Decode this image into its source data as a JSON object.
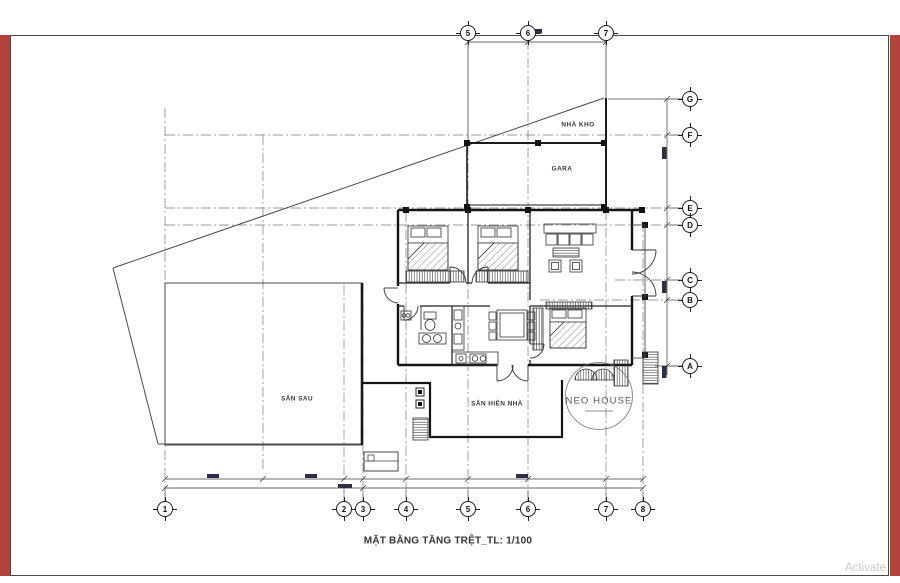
{
  "page": {
    "title": "MẶT BẰNG TẦNG TRỆT_TL: 1/100",
    "activate_text": "Activate",
    "accent_red": "#b2433b"
  },
  "plan": {
    "watermark": "NEO HOUSE",
    "rooms": {
      "storage": "NHÀ KHO",
      "garage": "GARA",
      "backyard": "SÂN SAU",
      "front_porch": "SÂN HIÊN NHÀ"
    }
  },
  "grid": {
    "top": [
      "5",
      "6",
      "7"
    ],
    "bottom": [
      "1",
      "2",
      "3",
      "4",
      "5",
      "6",
      "7",
      "8"
    ],
    "right": [
      "G",
      "F",
      "E",
      "D",
      "C",
      "B",
      "A"
    ]
  }
}
